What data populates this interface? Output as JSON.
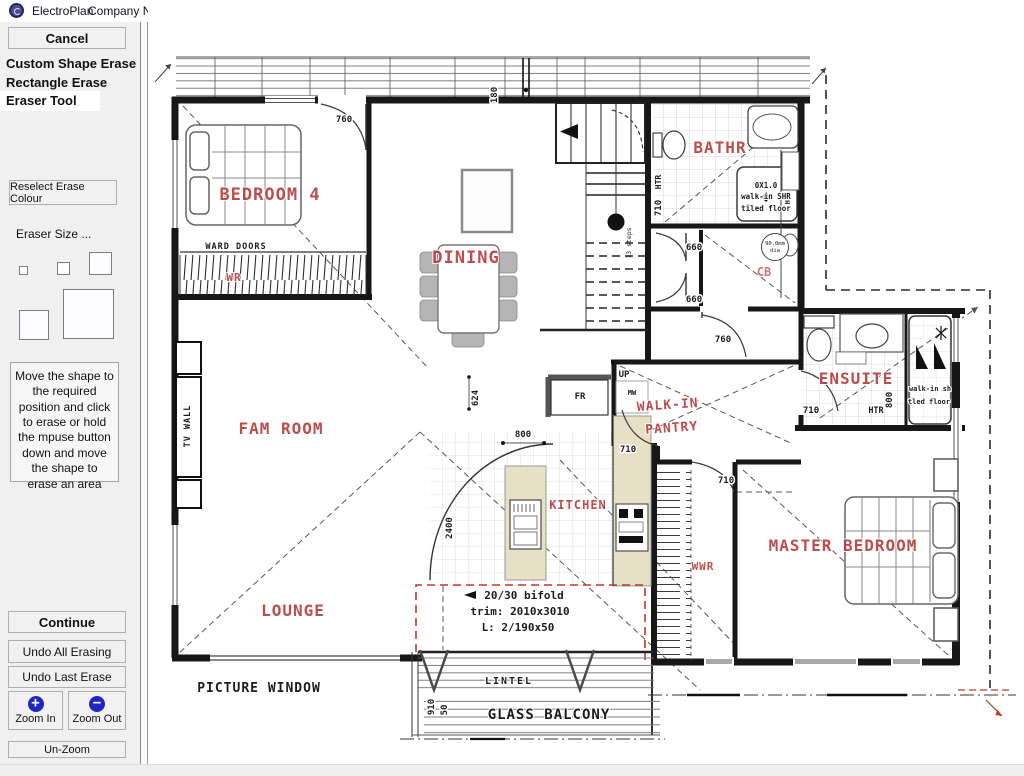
{
  "titlebar": {
    "app": "ElectroPlan",
    "company": "Company Name"
  },
  "sidebar": {
    "cancel": "Cancel",
    "modes": [
      {
        "label": "Custom Shape Erase"
      },
      {
        "label": "Rectangle Erase"
      },
      {
        "label": "Eraser Tool"
      }
    ],
    "reselect_colour": "Reselect Erase Colour",
    "eraser_size_label": "Eraser Size ...",
    "instructions": "Move the shape to the required position and click to erase or hold the mpuse button down and move the shape to erase an area",
    "continue": "Continue",
    "undo_all": "Undo All Erasing",
    "undo_last": "Undo Last Erase",
    "zoom_in": "Zoom In",
    "zoom_out": "Zoom Out",
    "zoom_in_glyph": "+",
    "zoom_out_glyph": "−",
    "un_zoom": "Un-Zoom"
  },
  "colors": {
    "accent_blue": "#2324c4",
    "room_label_red": "#b43636",
    "red_dash": "#c0392b",
    "bench_tan": "#e7dfc6"
  },
  "plan": {
    "rooms": {
      "bedroom4": "BEDROOM 4",
      "dining": "DINING",
      "bathroom": "BATHR",
      "ensuite": "ENSUITE",
      "fam_room": "FAM ROOM",
      "walkin_1": "WALK-IN",
      "walkin_2": "PANTRY",
      "kitchen": "KITCHEN",
      "master": "MASTER BEDROOM",
      "lounge": "LOUNGE",
      "wr": "WR",
      "cb": "CB",
      "wwr": "WWR"
    },
    "features": {
      "ward_doors": "WARD DOORS",
      "tv_wall": "TV WALL",
      "picture_window": "PICTURE WINDOW",
      "lintel": "LINTEL",
      "glass_balcony": "GLASS BALCONY",
      "fr": "FR",
      "mw": "MW",
      "up": "UP",
      "htr_bath": "HTR",
      "htr_col": "HTR",
      "htr_ensuite": "HTR",
      "steps": "13 steps",
      "shr_size": "0X1.0",
      "shr_type": "walk-in SHR",
      "shr_floor": "tiled floor",
      "ens_shr_type": "walk-in sh",
      "ens_shr_floor": "tled floor",
      "pipe_dia": "90.0mm",
      "pipe_dia2": "dia",
      "bifold": "20/30 bifold",
      "bifold_trim": "trim: 2010x3010",
      "bifold_lintel": "L: 2/190x50"
    },
    "dims": {
      "bed4_door": "760",
      "deck": "180",
      "hall_a": "660",
      "hall_b": "660",
      "hall_c": "760",
      "island": "624",
      "kitchen_w": "800",
      "kitchen_door": "710",
      "pantry_door": "710",
      "ensuite_door": "710",
      "bath_door": "710",
      "ensuite_w": "800",
      "kitchen_l": "2400",
      "balcony_a": "910",
      "balcony_b": "50"
    }
  }
}
